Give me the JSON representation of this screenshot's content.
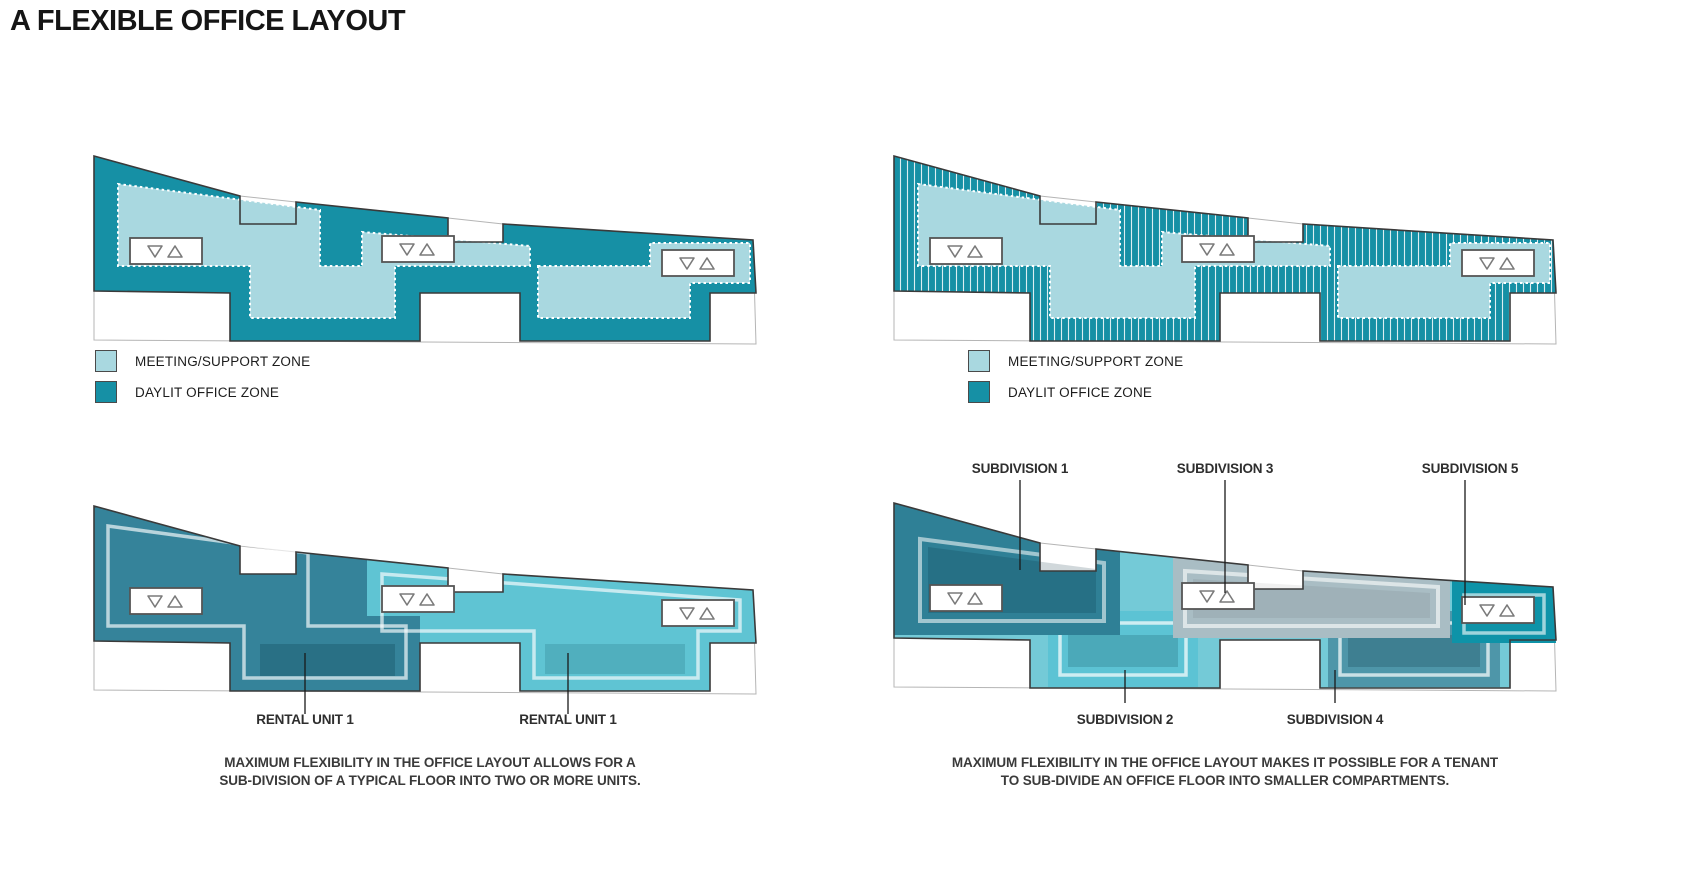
{
  "title": "A FLEXIBLE OFFICE LAYOUT",
  "legend": {
    "items": [
      {
        "label": "MEETING/SUPPORT ZONE",
        "color": "#A9D8E0"
      },
      {
        "label": "DAYLIT OFFICE ZONE",
        "color": "#1690A5"
      }
    ]
  },
  "colors": {
    "office_teal": "#1690A5",
    "meeting_light": "#A9D8E0",
    "outline": "#3A3A3A",
    "site_line": "#B5B5B5",
    "unit1_dark": "#35839A",
    "unit2_cyan": "#5FC4D3",
    "base_cyan": "#74CAD7",
    "sub1": "#2F8096",
    "sub2": "#5CC3D4",
    "sub3": "#A9BDC4",
    "sub4": "#4E96A9",
    "sub5": "#0E93A8"
  },
  "bottom_left": {
    "unit_labels": [
      "RENTAL UNIT 1",
      "RENTAL UNIT 1"
    ],
    "caption": [
      "MAXIMUM FLEXIBILITY IN THE OFFICE LAYOUT ALLOWS FOR A",
      "SUB-DIVISION OF A TYPICAL FLOOR INTO TWO OR MORE UNITS."
    ]
  },
  "bottom_right": {
    "top_labels": [
      "SUBDIVISION 1",
      "SUBDIVISION 3",
      "SUBDIVISION 5"
    ],
    "bottom_labels": [
      "SUBDIVISION 2",
      "SUBDIVISION 4"
    ],
    "caption": [
      "MAXIMUM FLEXIBILITY IN THE OFFICE LAYOUT MAKES IT POSSIBLE FOR A TENANT",
      "TO SUB-DIVIDE AN OFFICE FLOOR INTO SMALLER COMPARTMENTS."
    ]
  }
}
